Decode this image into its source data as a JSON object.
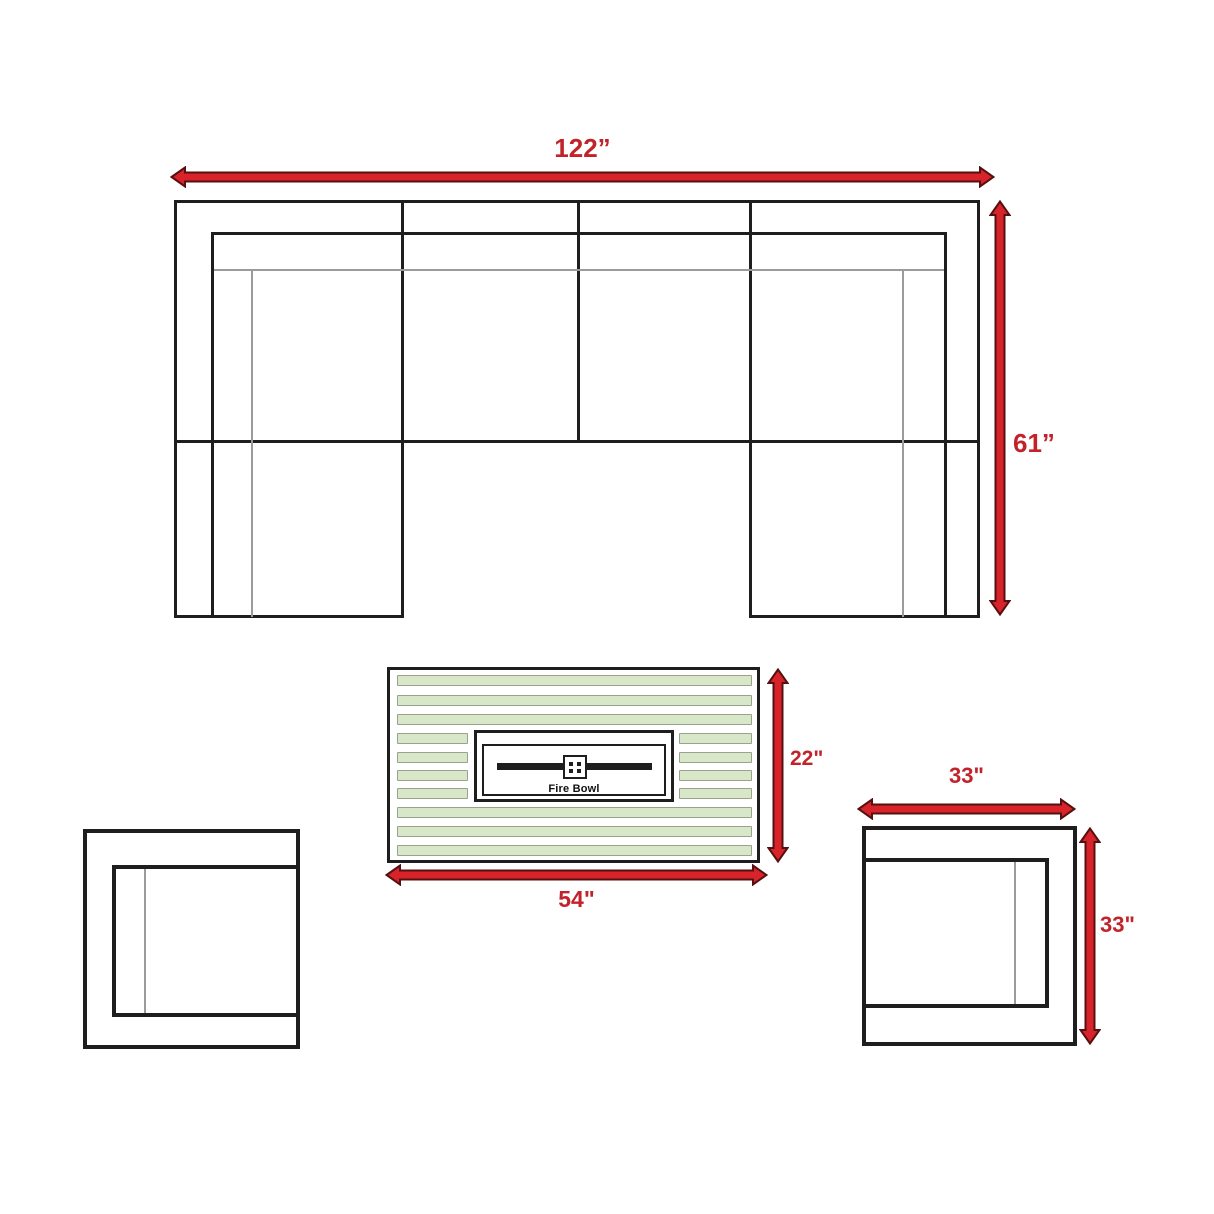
{
  "colors": {
    "background": "#ffffff",
    "line_black": "#1e1e1e",
    "thin_gray": "#9b9b9b",
    "arrow_red": "#d8232a",
    "arrow_outline": "#55100f",
    "label_red": "#c2232a",
    "slat_green": "#d8e7c7",
    "slat_border": "#97a38e"
  },
  "sofa": {
    "width_label": "122”",
    "height_label": "61”"
  },
  "fire_table": {
    "height_label": "22\"",
    "width_label": "54\"",
    "bowl_label": "Fire Bowl"
  },
  "right_chair": {
    "width_label": "33\"",
    "height_label": "33\""
  }
}
